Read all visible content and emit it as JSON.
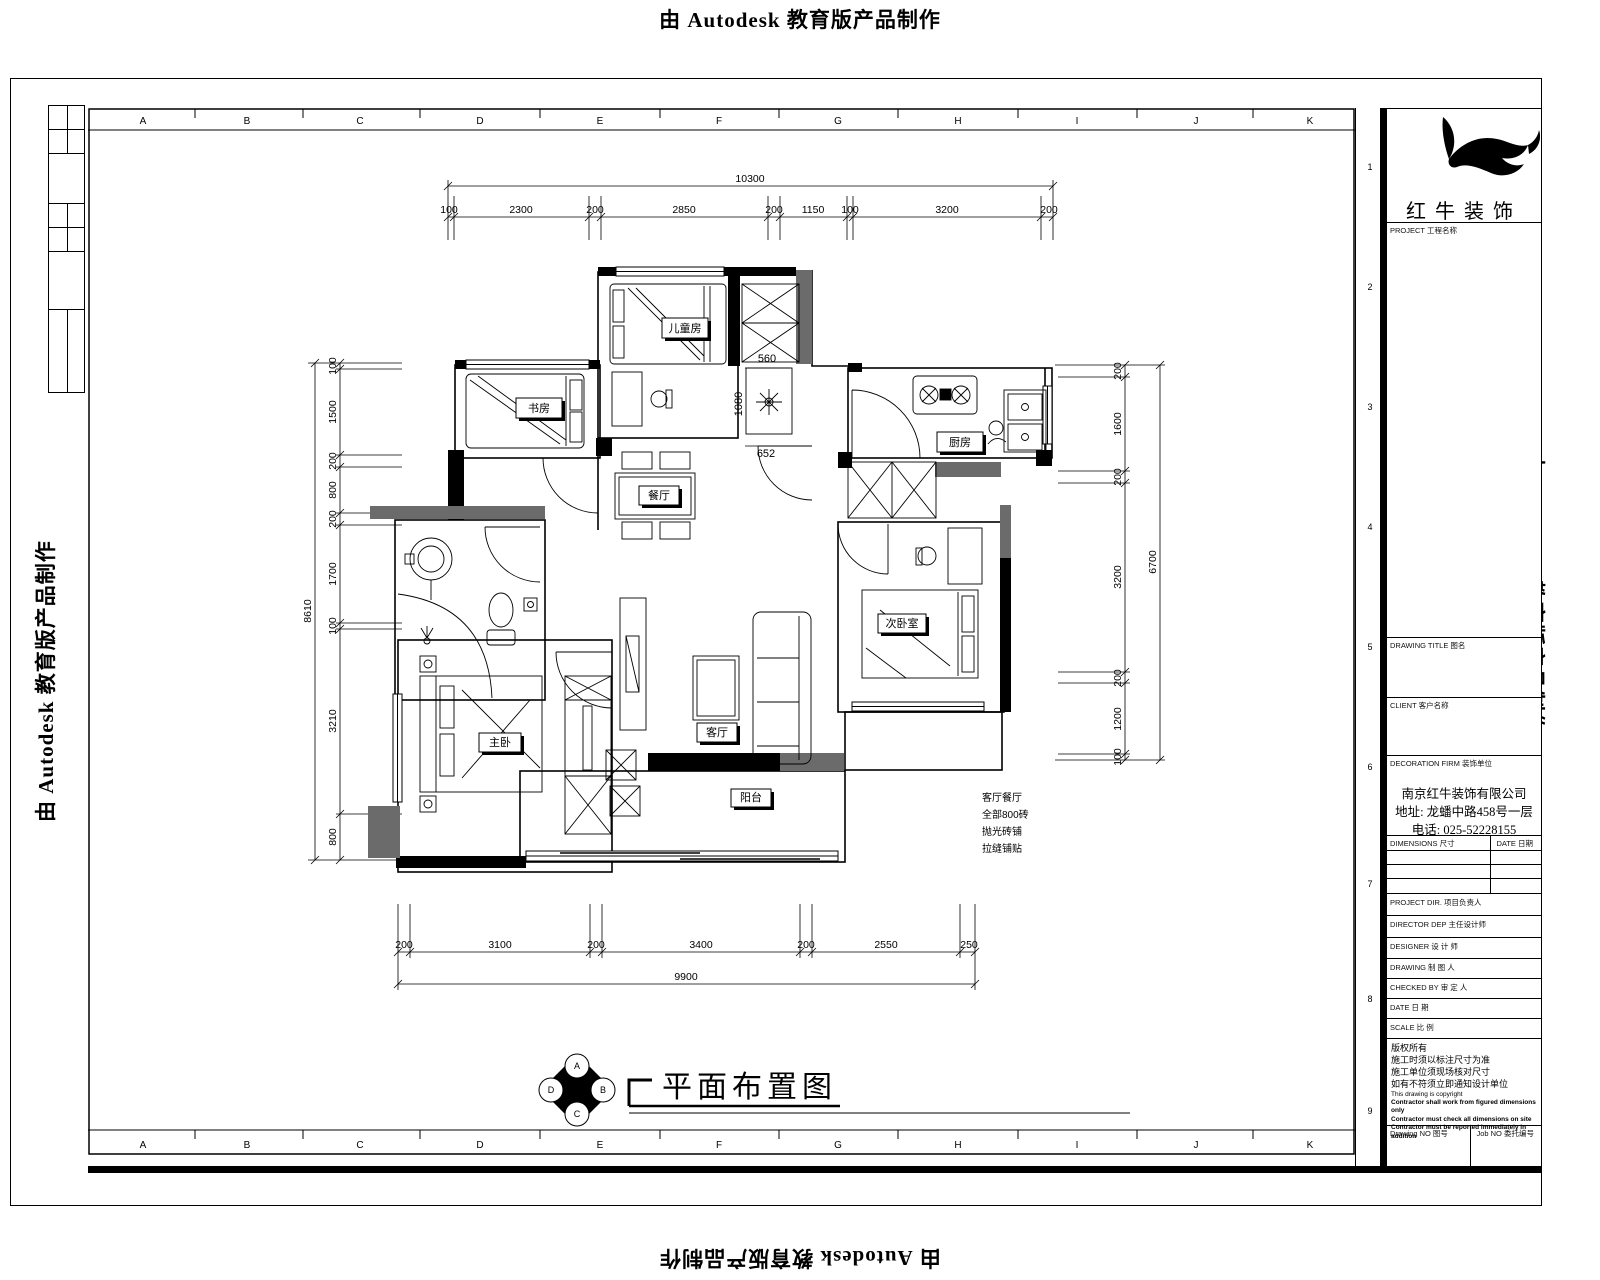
{
  "edge": {
    "autodesk_notice": "由 Autodesk 教育版产品制作"
  },
  "grid": {
    "columns": [
      "A",
      "B",
      "C",
      "D",
      "E",
      "F",
      "G",
      "H",
      "I",
      "J",
      "K"
    ],
    "rows": [
      "1",
      "2",
      "3",
      "4",
      "5",
      "6",
      "7",
      "8",
      "9"
    ]
  },
  "title_block": {
    "brand": "红牛装饰",
    "project_label": "PROJECT 工程名称",
    "drawing_title_label": "DRAWING TITLE 图名",
    "client_label": "CLIENT 客户名称",
    "firm_label": "DECORATION FIRM 装饰单位",
    "company": {
      "name": "南京红牛装饰有限公司",
      "address": "地址: 龙蟠中路458号一层",
      "phone": "电话: 025-52228155"
    },
    "dimensions_label": "DIMENSIONS 尺寸",
    "date_col_label": "DATE 日期",
    "fields": [
      {
        "label": "PROJECT DIR. 项目负责人"
      },
      {
        "label": "DIRECTOR DEP 主任设计师"
      },
      {
        "label": "DESIGNER 设 计 师"
      },
      {
        "label": "DRAWING 制 图 人"
      },
      {
        "label": "CHECKED BY 审 定 人"
      },
      {
        "label": "DATE 日 期"
      },
      {
        "label": "SCALE 比 例"
      }
    ],
    "notes": [
      "版权所有",
      "施工时须以标注尺寸为准",
      "施工单位须现场核对尺寸",
      "如有不符须立即通知设计单位",
      "This drawing is copyright",
      "Contractor shall work from figured dimensions only",
      "Contractor must check all dimensions on site",
      "Contractor must be reported immediately in addition"
    ],
    "drawing_no_label": "Drawing NO 图号",
    "job_no_label": "Job NO 委托编号"
  },
  "plan": {
    "title": "平面布置图",
    "rooms": {
      "children": "儿童房",
      "study": "书房",
      "dining": "餐厅",
      "kitchen": "厨房",
      "living": "客厅",
      "master": "主卧",
      "second": "次卧室",
      "balcony": "阳台"
    },
    "notes": [
      "客厅餐厅",
      "全部800砖",
      "抛光砖铺",
      "拉缝铺贴"
    ],
    "inline_dims": {
      "a": "560",
      "b": "1080",
      "c": "652"
    },
    "dims": {
      "top": {
        "total": "10300",
        "segments": [
          "100",
          "2300",
          "200",
          "2850",
          "200",
          "1150",
          "100",
          "3200",
          "200"
        ]
      },
      "bottom": {
        "total": "9900",
        "segments": [
          "200",
          "3100",
          "200",
          "3400",
          "200",
          "2550",
          "250"
        ]
      },
      "left": {
        "total": "8610",
        "segments": [
          "100",
          "1500",
          "200",
          "800",
          "200",
          "1700",
          "100",
          "3210",
          "800"
        ]
      },
      "right": {
        "total": "6700",
        "segments": [
          "200",
          "1600",
          "200",
          "3200",
          "200",
          "1200",
          "100"
        ]
      }
    },
    "elevation_symbol": [
      "A",
      "B",
      "C",
      "D"
    ]
  }
}
